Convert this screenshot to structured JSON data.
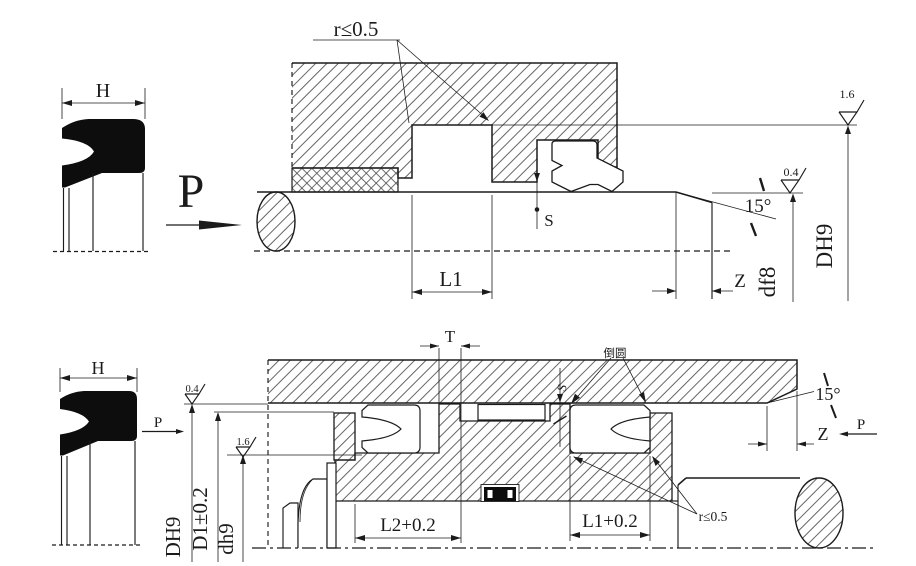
{
  "drawing": {
    "background": "#ffffff",
    "line_color": "#1b1b1b",
    "top_view": {
      "seal_section_width": "H",
      "pressure": "P",
      "groove_radius_note": "r≤0.5",
      "groove_length": "L1",
      "clearance": "S",
      "lead_in_angle": "15°",
      "lead_in_length": "Z",
      "bore_surface_roughness": "1.6",
      "rod_surface_roughness": "0.4",
      "groove_bore_diameter": "DH9",
      "rod_diameter": "df8"
    },
    "bottom_view": {
      "seal_section_width": "H",
      "pressure_left": "P",
      "pressure_right": "P",
      "bore_surface_roughness": "0.4",
      "groove_surface_roughness": "1.6",
      "bore_diameter": "DH9",
      "groove_diameter": "D1±0.2",
      "rod_diameter": "dh9",
      "land_width": "T",
      "round_corner_note": "倒圆",
      "groove_radius_note": "r≤0.5",
      "lead_in_angle": "15°",
      "lead_in_length": "Z",
      "clearance": "S",
      "left_groove_length": "L2+0.2",
      "right_groove_length": "L1+0.2"
    }
  }
}
